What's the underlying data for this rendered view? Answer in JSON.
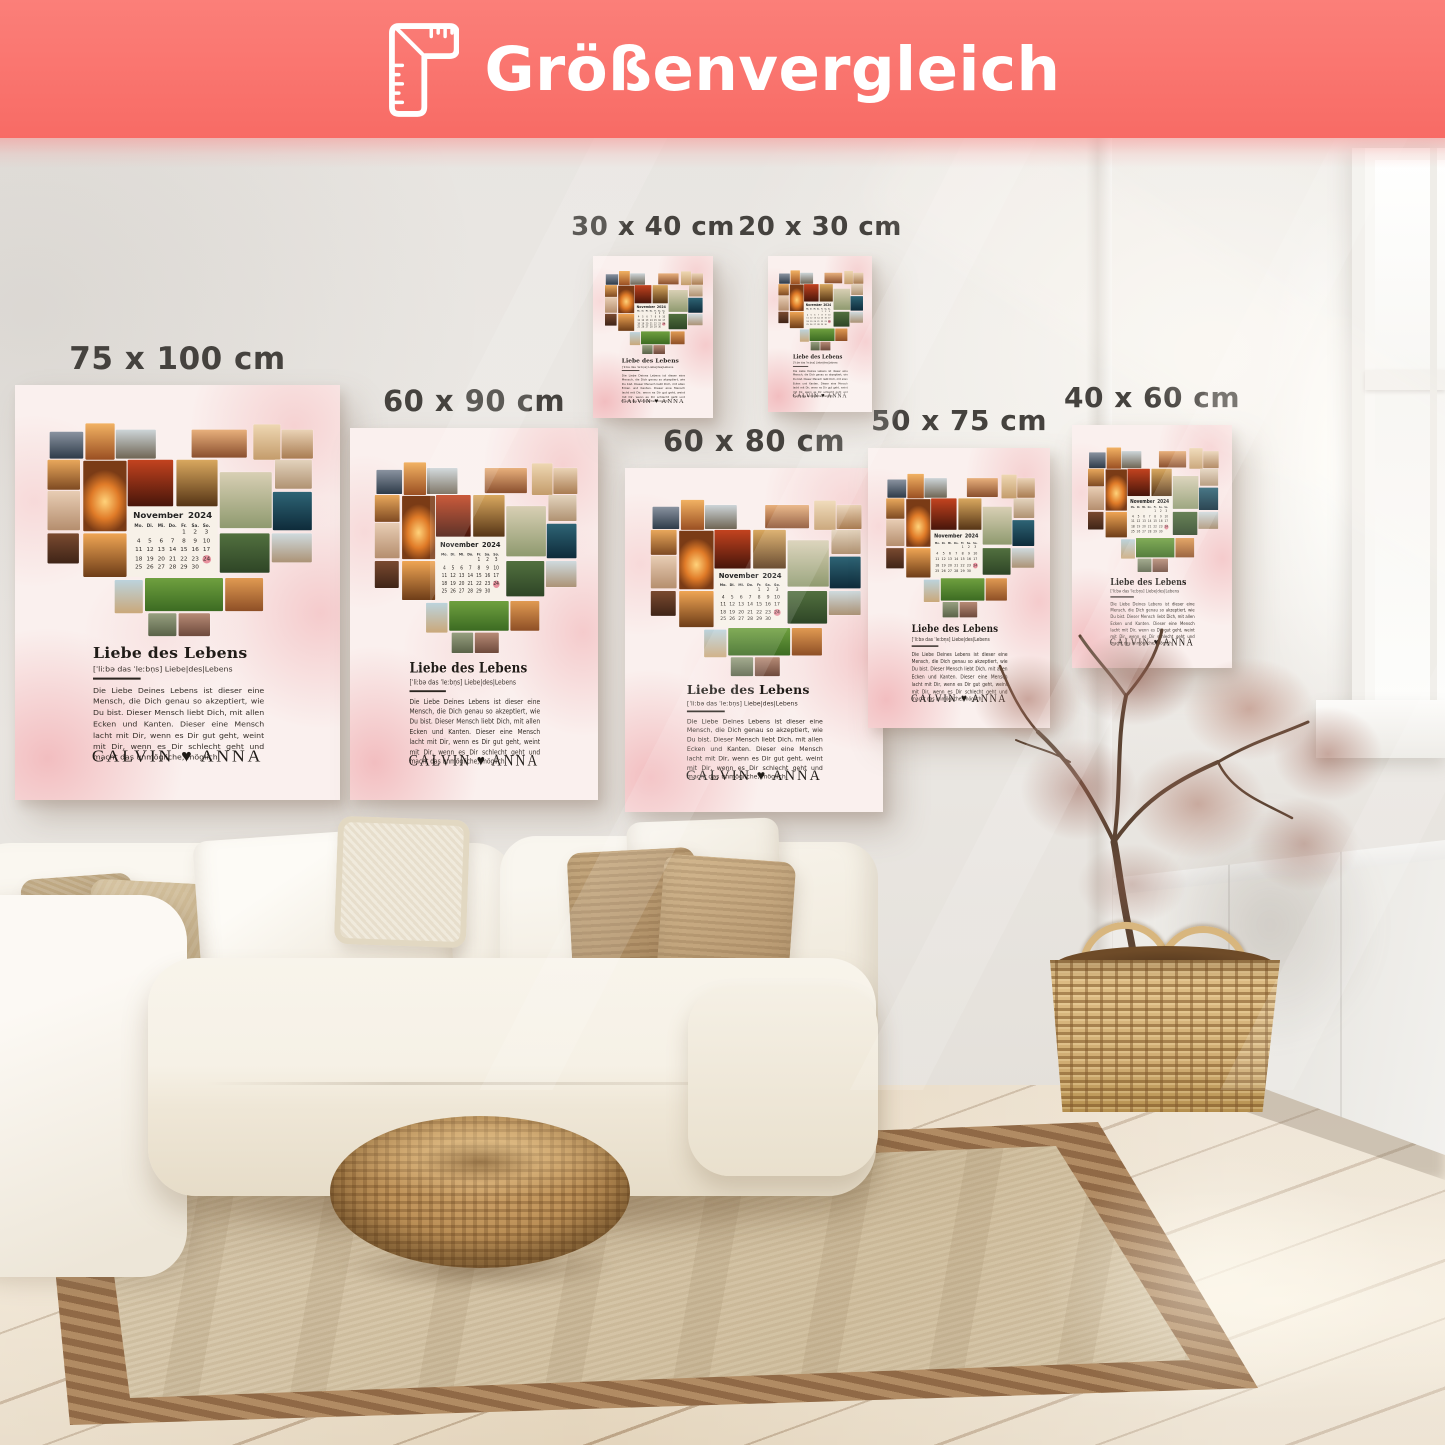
{
  "header": {
    "title": "Größenvergleich",
    "icon": "ruler-corner-icon",
    "background_color": "#F9706B",
    "text_color": "#FFFFFF"
  },
  "posters": {
    "design": {
      "title": "Liebe des Lebens",
      "phonetic": "[ˈliːbə das ˈleːbn̩s]  Liebe|des|Lebens",
      "description": "Die Liebe Deines Lebens ist dieser eine Mensch, die Dich genau so akzeptiert, wie Du bist. Dieser Mensch liebt Dich, mit allen Ecken und Kanten. Dieser eine Mensch lacht mit Dir, wenn es Dir gut geht, weint mit Dir, wenn es Dir schlecht geht und macht das unmögliche, möglich.",
      "names": "CALVIN ♥ ANNA",
      "background_color": "#F9EDEC",
      "calendar": {
        "month": "November",
        "year": "2024",
        "weekdays": [
          "Mo.",
          "Di.",
          "Mi.",
          "Do.",
          "Fr.",
          "Sa.",
          "So."
        ],
        "weeks": [
          [
            "",
            "",
            "",
            "",
            "1",
            "2",
            "3"
          ],
          [
            "4",
            "5",
            "6",
            "7",
            "8",
            "9",
            "10"
          ],
          [
            "11",
            "12",
            "13",
            "14",
            "15",
            "16",
            "17"
          ],
          [
            "18",
            "19",
            "20",
            "21",
            "22",
            "23",
            "24"
          ],
          [
            "25",
            "26",
            "27",
            "28",
            "29",
            "30",
            ""
          ]
        ],
        "highlighted_day": "24",
        "highlight_color": "#E8919E"
      },
      "photos": [
        {
          "name": "mountain-couple-photo",
          "x": 32,
          "y": 45,
          "w": 31,
          "h": 26,
          "bg": "linear-gradient(180deg,#8a93a0,#2e3b49)"
        },
        {
          "name": "sunset-person-photo",
          "x": 65,
          "y": 37,
          "w": 27,
          "h": 35,
          "bg": "linear-gradient(180deg,#f2b263,#9a4f22)"
        },
        {
          "name": "rock-couple-photo",
          "x": 93,
          "y": 43,
          "w": 37,
          "h": 28,
          "bg": "linear-gradient(180deg,#cdd5d8,#6f6554)"
        },
        {
          "name": "warm-couple-photo",
          "x": 163,
          "y": 43,
          "w": 51,
          "h": 27,
          "bg": "linear-gradient(180deg,#e8b07c,#8a4f2e)"
        },
        {
          "name": "sand-woman-photo",
          "x": 220,
          "y": 38,
          "w": 25,
          "h": 34,
          "bg": "linear-gradient(180deg,#eed7b2,#c49c6b)"
        },
        {
          "name": "beach-couple-photo",
          "x": 246,
          "y": 43,
          "w": 29,
          "h": 28,
          "bg": "linear-gradient(180deg,#ead3b6,#a97c52)"
        },
        {
          "name": "sunset-field-photo",
          "x": 30,
          "y": 72,
          "w": 30,
          "h": 29,
          "bg": "linear-gradient(180deg,#e9a85c,#7e4a22)"
        },
        {
          "name": "lying-person-photo",
          "x": 30,
          "y": 102,
          "w": 30,
          "h": 38,
          "bg": "linear-gradient(180deg,#e8cdb4,#b58e6e)"
        },
        {
          "name": "sunset-chairs-photo",
          "x": 63,
          "y": 73,
          "w": 40,
          "h": 68,
          "bg": "radial-gradient(60% 45% at 50% 58%,#ffd27a 0%,#e07b28 55%,#7a3b16 100%)"
        },
        {
          "name": "red-sunset-photo",
          "x": 104,
          "y": 72,
          "w": 42,
          "h": 45,
          "bg": "linear-gradient(180deg,#c3431f,#47150a)"
        },
        {
          "name": "golden-silhouette-photo",
          "x": 149,
          "y": 72,
          "w": 38,
          "h": 45,
          "bg": "linear-gradient(180deg,#d9a85f,#553415)"
        },
        {
          "name": "dunes-wedding-photo",
          "x": 189,
          "y": 84,
          "w": 48,
          "h": 54,
          "bg": "linear-gradient(180deg,#d8cfb4,#8f9a6f)"
        },
        {
          "name": "beach-walk-photo",
          "x": 240,
          "y": 72,
          "w": 34,
          "h": 28,
          "bg": "linear-gradient(180deg,#e3d3bd,#b09272)"
        },
        {
          "name": "teal-sea-photo",
          "x": 238,
          "y": 103,
          "w": 36,
          "h": 37,
          "bg": "linear-gradient(180deg,#2e6475,#0e2b3a)"
        },
        {
          "name": "hands-heart-photo",
          "x": 63,
          "y": 143,
          "w": 40,
          "h": 42,
          "bg": "linear-gradient(180deg,#efa554,#6e3d18)"
        },
        {
          "name": "picnic-food-photo",
          "x": 30,
          "y": 143,
          "w": 29,
          "h": 29,
          "bg": "linear-gradient(180deg,#7a4a30,#3f2417)"
        },
        {
          "name": "wedding-arch-photo",
          "x": 189,
          "y": 143,
          "w": 46,
          "h": 38,
          "bg": "linear-gradient(180deg,#52703f,#2e4526)"
        },
        {
          "name": "beach-small-photo",
          "x": 237,
          "y": 143,
          "w": 37,
          "h": 28,
          "bg": "linear-gradient(180deg,#cfdade,#ac9376)"
        },
        {
          "name": "beach-standing-photo",
          "x": 92,
          "y": 188,
          "w": 26,
          "h": 32,
          "bg": "linear-gradient(180deg,#bcd3dc,#caa87a)"
        },
        {
          "name": "grass-couple-photo",
          "x": 120,
          "y": 186,
          "w": 72,
          "h": 32,
          "bg": "linear-gradient(180deg,#6fa03f,#3c6b22)"
        },
        {
          "name": "picnic-warm-photo",
          "x": 194,
          "y": 186,
          "w": 35,
          "h": 32,
          "bg": "linear-gradient(180deg,#e09a52,#8e4f26)"
        },
        {
          "name": "point-left-photo",
          "x": 123,
          "y": 220,
          "w": 26,
          "h": 22,
          "bg": "linear-gradient(180deg,#97a080,#5a6248)"
        },
        {
          "name": "hug-couple-photo",
          "x": 151,
          "y": 220,
          "w": 29,
          "h": 22,
          "bg": "linear-gradient(180deg,#b78b76,#6e4a3c)"
        }
      ]
    },
    "sizes": [
      {
        "label": "75 x 100 cm",
        "x": 15,
        "y": 385,
        "w": 325,
        "h": 415,
        "label_size": 31
      },
      {
        "label": "60 x 90 cm",
        "x": 350,
        "y": 428,
        "w": 248,
        "h": 372,
        "label_size": 29
      },
      {
        "label": "30 x 40 cm",
        "x": 593,
        "y": 256,
        "w": 120,
        "h": 162,
        "label_size": 26
      },
      {
        "label": "20 x 30 cm",
        "x": 768,
        "y": 256,
        "w": 104,
        "h": 156,
        "label_size": 26
      },
      {
        "label": "60 x 80 cm",
        "x": 625,
        "y": 468,
        "w": 258,
        "h": 344,
        "label_size": 29
      },
      {
        "label": "50 x 75 cm",
        "x": 868,
        "y": 448,
        "w": 182,
        "h": 280,
        "label_size": 28
      },
      {
        "label": "40 x 60 cm",
        "x": 1072,
        "y": 425,
        "w": 160,
        "h": 243,
        "label_size": 28
      }
    ]
  },
  "palette": {
    "wall": "#E9E6E2",
    "floor": "#E8DAC3",
    "rug_field": "#D6C5A8",
    "rug_border": "#A98159",
    "sofa": "#F7F3EA",
    "pillow_tan": "#C4AE89",
    "pouf": "#B98E57",
    "basket": "#D9B87F",
    "label_color": "#45423E"
  }
}
